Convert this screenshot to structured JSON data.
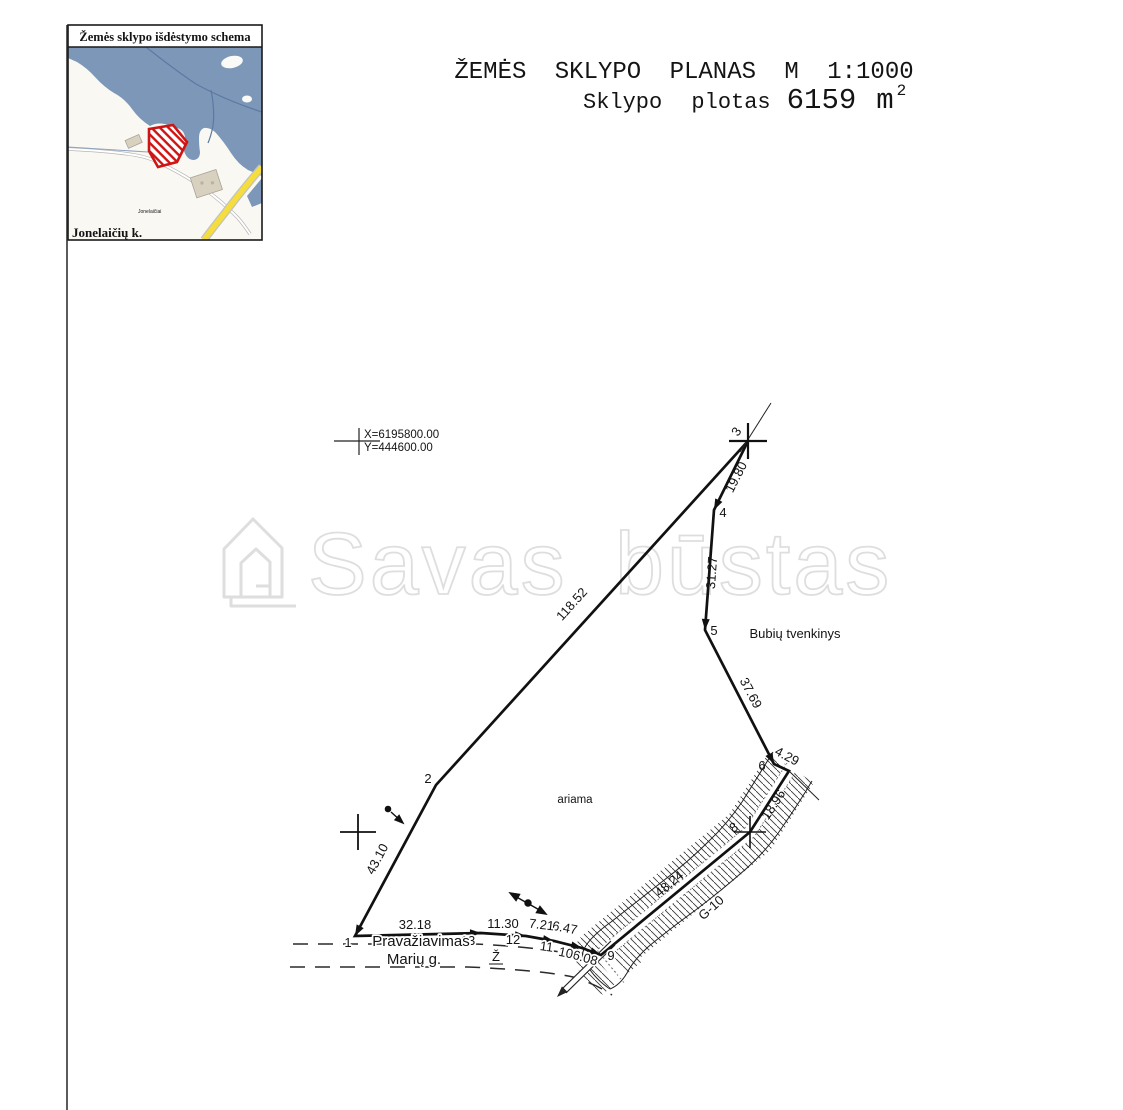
{
  "inset": {
    "title": "Žemės sklypo išdėstymo schema",
    "village": "Jonelaičių k.",
    "place": "Jonelaičiai",
    "colors": {
      "water": "#7d97b9",
      "land": "#faf8f3",
      "plot": "#cf1414",
      "road_yellow": "#f4dd3c",
      "building": "#d9d1c0"
    }
  },
  "header": {
    "title": "ŽEMĖS SKLYPO PLANAS M 1:1000",
    "area_prefix": "Sklypo plotas",
    "area_value": "6159",
    "area_unit": "m",
    "area_exp": "2"
  },
  "coords": {
    "x": "X=6195800.00",
    "y": "Y=444600.00"
  },
  "watermark": {
    "text": "Savas būstas"
  },
  "plan": {
    "vertices": [
      {
        "n": "1"
      },
      {
        "n": "2"
      },
      {
        "n": "3"
      },
      {
        "n": "4"
      },
      {
        "n": "5"
      },
      {
        "n": "6"
      },
      {
        "n": "8"
      },
      {
        "n": "9"
      },
      {
        "n": "10"
      },
      {
        "n": "11"
      },
      {
        "n": "12"
      },
      {
        "n": "13"
      }
    ],
    "edges": [
      {
        "len": "43.10"
      },
      {
        "len": "118.52"
      },
      {
        "len": "19.80"
      },
      {
        "len": "31.27"
      },
      {
        "len": "37.69"
      },
      {
        "len": "4.29"
      },
      {
        "len": "18.96"
      },
      {
        "len": "48.24"
      },
      {
        "len": "6.08"
      },
      {
        "len": "6.47"
      },
      {
        "len": "7.21"
      },
      {
        "len": "11.30"
      },
      {
        "len": "32.18"
      }
    ],
    "labels": {
      "land_use": "ariama",
      "pond": "Bubių tvenkinys",
      "passage": "Pravažiavimas",
      "street": "Marių g.",
      "street_mark": "Ž",
      "ditch_code": "G-10"
    }
  }
}
